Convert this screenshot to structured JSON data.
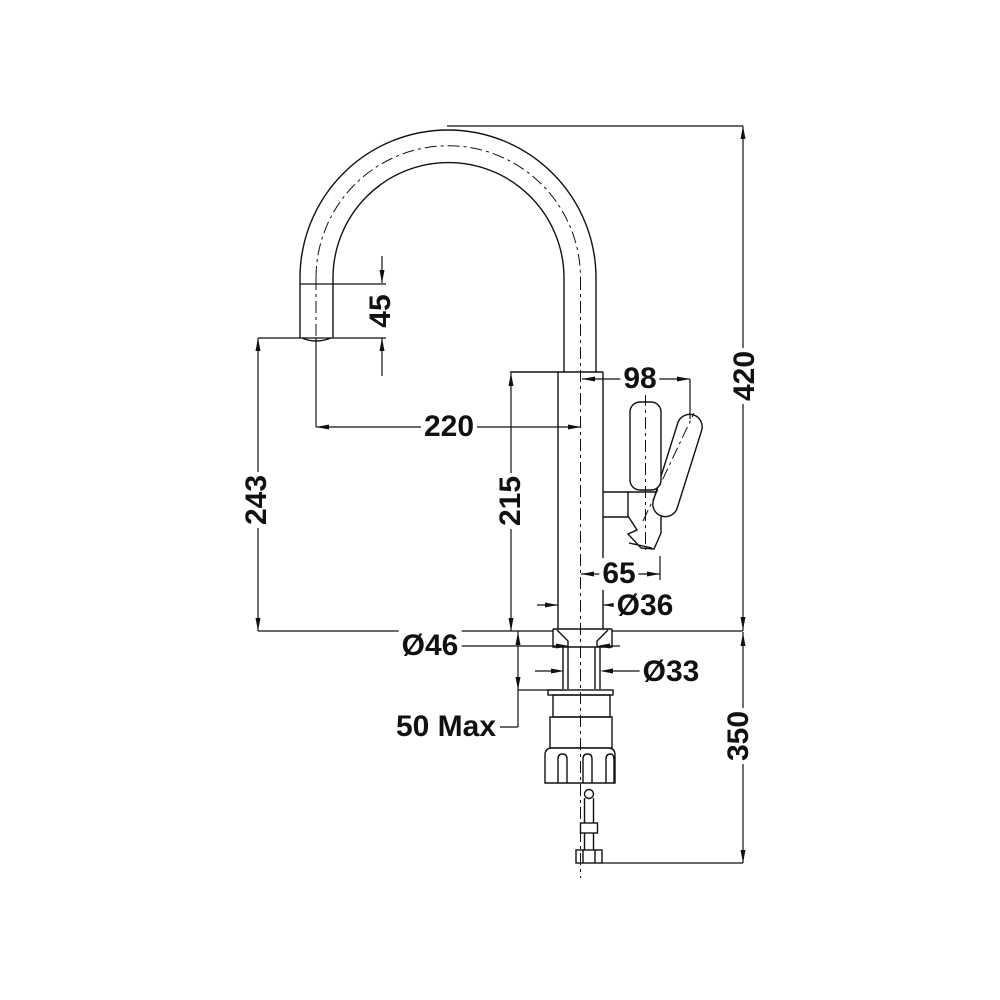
{
  "drawing": {
    "type": "technical-dimension-drawing",
    "subject": "kitchen-faucet-side-elevation",
    "background": "#ffffff",
    "line_color": "#111111",
    "dimensions": [
      {
        "id": "spout-tip-length",
        "label": "45",
        "orientation": "vertical"
      },
      {
        "id": "overall-height",
        "label": "420",
        "orientation": "vertical"
      },
      {
        "id": "handle-offset",
        "label": "98",
        "orientation": "horizontal"
      },
      {
        "id": "spout-reach",
        "label": "220",
        "orientation": "horizontal"
      },
      {
        "id": "spout-outlet-height",
        "label": "243",
        "orientation": "vertical"
      },
      {
        "id": "body-height",
        "label": "215",
        "orientation": "vertical"
      },
      {
        "id": "handle-reach",
        "label": "65",
        "orientation": "horizontal"
      },
      {
        "id": "body-diameter",
        "label": "Ø36",
        "orientation": "horizontal"
      },
      {
        "id": "base-diameter",
        "label": "Ø46",
        "orientation": "horizontal"
      },
      {
        "id": "shank-diameter",
        "label": "Ø33",
        "orientation": "horizontal"
      },
      {
        "id": "max-counter-thickness",
        "label": "50 Max",
        "orientation": "horizontal"
      },
      {
        "id": "under-counter-depth",
        "label": "350",
        "orientation": "vertical"
      }
    ]
  }
}
